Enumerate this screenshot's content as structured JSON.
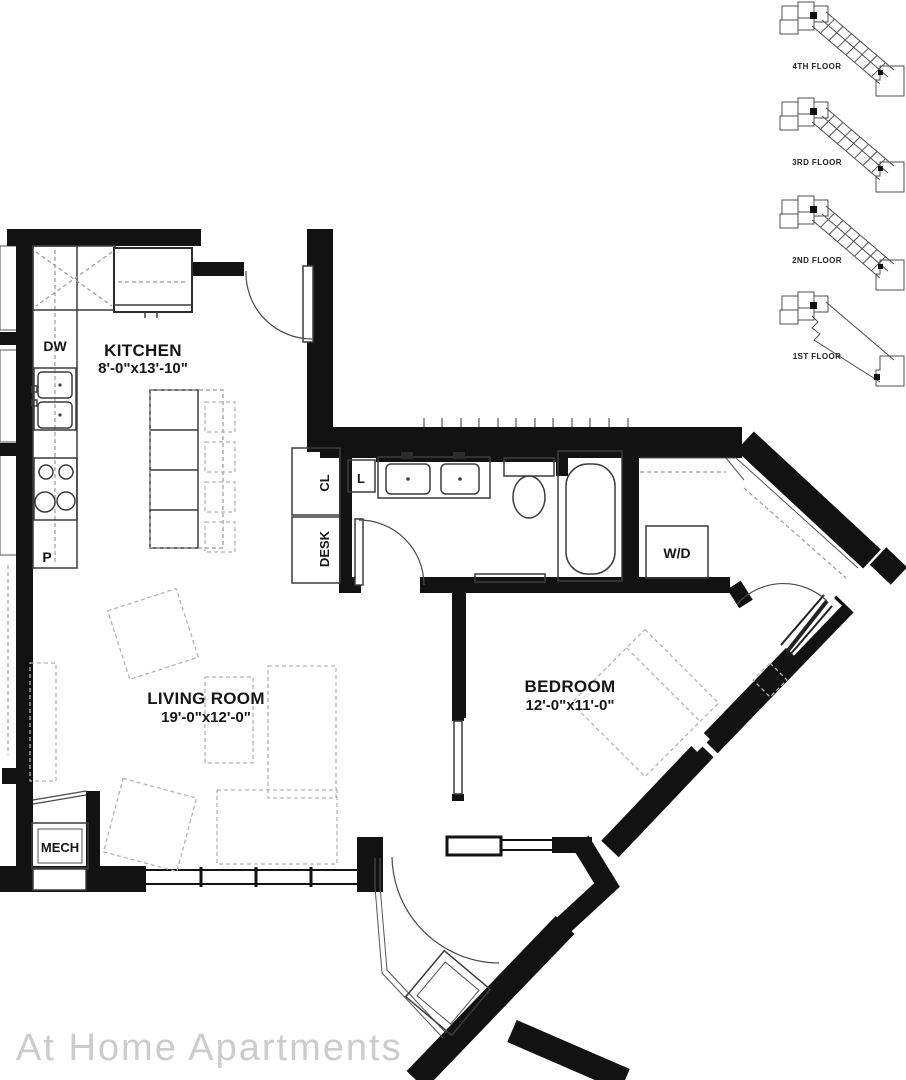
{
  "watermark": "At Home Apartments",
  "rooms": {
    "kitchen": {
      "name": "KITCHEN",
      "dims": "8'-0\"x13'-10\""
    },
    "living": {
      "name": "LIVING ROOM",
      "dims": "19'-0\"x12'-0\""
    },
    "bedroom": {
      "name": "BEDROOM",
      "dims": "12'-0\"x11'-0\""
    }
  },
  "fixtures": {
    "dishwasher": "DW",
    "pantry": "P",
    "linen": "L",
    "closet": "CL",
    "desk": "DESK",
    "washer_dryer": "W/D",
    "mechanical": "MECH"
  },
  "floor_key": [
    {
      "label": "4TH FLOOR"
    },
    {
      "label": "3RD FLOOR"
    },
    {
      "label": "2ND FLOOR"
    },
    {
      "label": "1ST FLOOR"
    }
  ],
  "colors": {
    "wall": "#121212",
    "fixture_line": "#3c3c3c",
    "furniture_dash": "#b3b3b3",
    "watermark": "#cccccc"
  }
}
